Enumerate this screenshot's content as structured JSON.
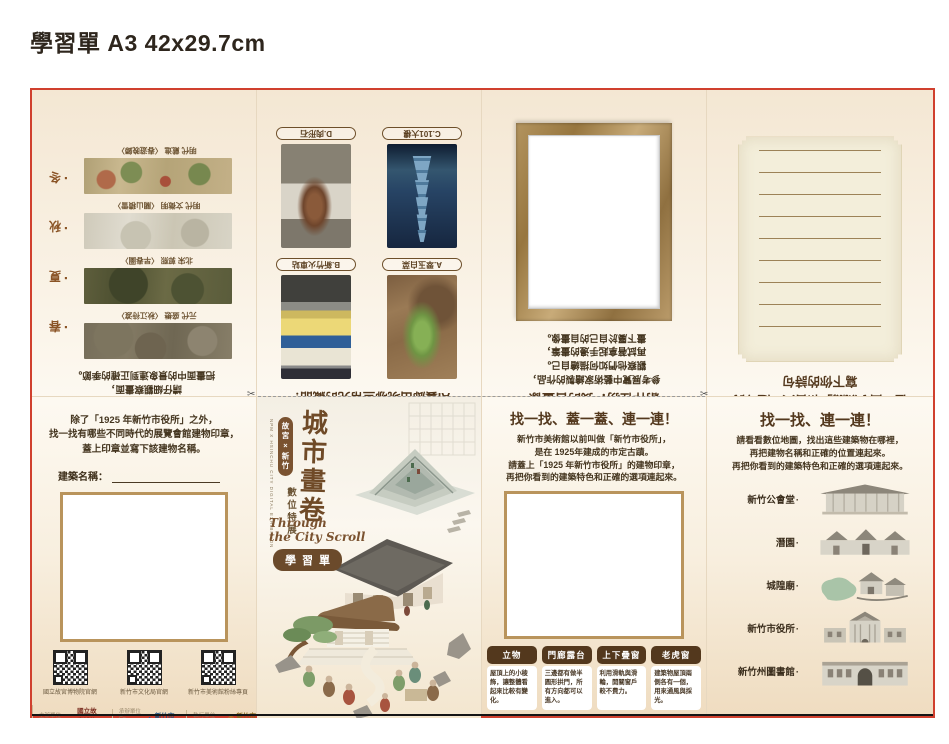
{
  "page": {
    "heading": "學習單 A3 42x29.7cm"
  },
  "colors": {
    "border_red": "#d0402e",
    "accent_brown": "#53381d",
    "badge_brown": "#6b4a2b",
    "artboard_beige": "#f4e7d3",
    "stamp_border": "#b9945c"
  },
  "four_seasons": {
    "instruction_lines": [
      "在這次展覽「四季行旅」中，",
      "請仔細觀察畫面，",
      "把畫面中的景象連到正確的季節。"
    ],
    "seasons": [
      "春",
      "夏",
      "秋",
      "冬"
    ],
    "paintings": [
      {
        "label": "元代 盛懋 〈秋江待渡〉"
      },
      {
        "label": "北宋 郭熙 〈早春圖〉"
      },
      {
        "label": "明代 文徵明 〈關山積雪〉"
      },
      {
        "label": "明代 戴進 〈春遊晚歸〉"
      }
    ]
  },
  "ai_gallery": {
    "title": "AI藝廊出現哪些常見的藏品？",
    "items": [
      {
        "label": "A.翠玉白菜"
      },
      {
        "label": "B.新竹火車站"
      },
      {
        "label": "C.101大樓"
      },
      {
        "label": "D.肉形石"
      }
    ]
  },
  "self_portrait": {
    "title": "創作任務：我的自畫像",
    "instruction_lines": [
      "參考展覽中藝術家繪製的作品，",
      "觀察他們如何描繪自己。",
      "再試著拿起手邊的畫筆，",
      "畫下屬於自己的自畫像。"
    ]
  },
  "poem": {
    "title_lines": [
      "在「曲水流觴」和古人一起吟詩",
      "寫下你的詩句"
    ]
  },
  "stamp_hunt": {
    "instruction_lines": [
      "除了「1925 年新竹市役所」之外，",
      "找一找有哪些不同時代的展覽會館建物印章，",
      "蓋上印章並寫下該建物名稱。"
    ],
    "field_label": "建築名稱：",
    "qr_codes": [
      {
        "caption": "國立故宮博物院官網"
      },
      {
        "caption": "新竹市文化局官網"
      },
      {
        "caption": "新竹市美術館粉絲專頁"
      }
    ],
    "credits": [
      {
        "role": "主辦單位",
        "role_en": "Organizer",
        "glyph": "▲",
        "org": "國立故宮博物院"
      },
      {
        "role": "承辦單位",
        "role_en": "Co-organizer",
        "glyph": "◆",
        "org": "新竹市政府"
      },
      {
        "role": "執行單位",
        "role_en": "Implementer",
        "glyph": "❂",
        "org": "新竹市美術館"
      }
    ]
  },
  "cover": {
    "title": "城市畫卷",
    "badge": "故宮×新竹",
    "subtitle": "數位特展",
    "subtitle_en": "NPM X HSINCHU CITY DIGITAL EXHIBITION",
    "script_line1": "Through",
    "script_line2": "the City Scroll",
    "tag": "學習單"
  },
  "feature_match": {
    "title": "找一找、蓋一蓋、連一連！",
    "instruction_lines": [
      "新竹市美術館以前叫做「新竹市役所」，",
      "是在 1925年建成的市定古蹟。",
      "請蓋上「1925 年新竹市役所」的建物印章，",
      "再把你看到的建築特色和正確的選項連起來。"
    ],
    "features": [
      {
        "name": "立物",
        "desc": "屋頂上的小稜飾，讓整體看起來比較有變化。"
      },
      {
        "name": "門廊露台",
        "desc": "三邊都有做半圓形拱門，所有方向都可以進入。"
      },
      {
        "name": "上下疊窗",
        "desc": "利用滑軌與滑輪，開關窗戶較不費力。"
      },
      {
        "name": "老虎窗",
        "desc": "建築物屋頂兩側各有一個，用來通風與採光。"
      }
    ]
  },
  "map_match": {
    "title": "找一找、連一連！",
    "instruction_lines": [
      "請看看數位地圖，找出這些建築物在哪裡，",
      "再把建物名稱和正確的位置連起來。",
      "再把你看到的建築特色和正確的選項連起來。"
    ],
    "buildings": [
      {
        "name": "新竹公會堂"
      },
      {
        "name": "潛園"
      },
      {
        "name": "城隍廟"
      },
      {
        "name": "新竹市役所"
      },
      {
        "name": "新竹州圖書館"
      }
    ]
  },
  "marks": {
    "scissors": "✂",
    "dot": "·"
  }
}
